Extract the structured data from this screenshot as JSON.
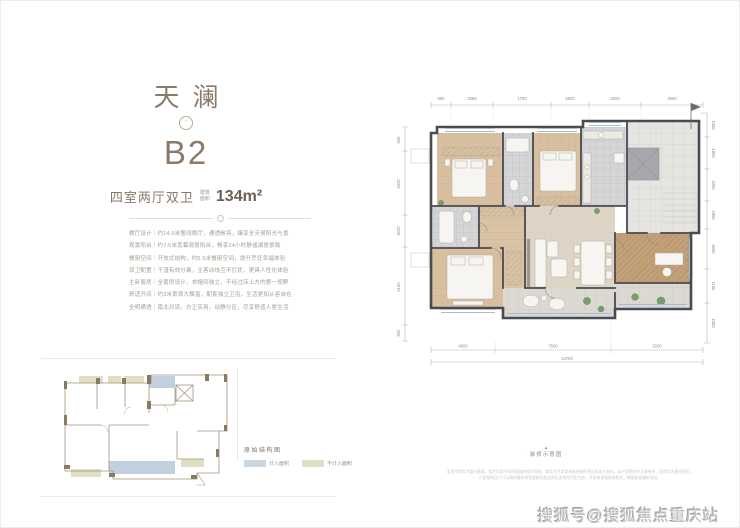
{
  "panel": {
    "project_name": "天澜",
    "unit_code": "B2",
    "layout_type": "四室两厅双卫",
    "area_label_line1": "建筑",
    "area_label_line2": "面积",
    "area_value": "134m²",
    "features": [
      "横厅设计｜约14.6米奢阔横厅，通透敞亮，臻享全天候阳光与景",
      "观景阳台｜约7.5米宽幕观景阳台，畅享24小时静谧湖居景致",
      "餐厨空间｜开放式结构，约5.5米餐厨空间，提升烹饪幸福体验",
      "双卫配置｜干湿有效分离，主客动线互不打扰，更具人性化体验",
      "主卧套房｜全套房设计，衣帽间独立，不经过床上方的第一视野",
      "舒适开间｜约3米景观大飘窗，配套独立卫浴，生活更加从容自在",
      "全明通透｜南北对流，方正实用，动静分区，尽享舒适人居生活"
    ]
  },
  "floorplan": {
    "caption_marker": "▲",
    "caption": "· 装修示意图 ·",
    "disclaimer_line1": "本宣传资料为要约邀请，相关内容不排除因政府相关规划、规定及开发商未能控制的原因而发生变化，本户型图仅作示意参考，面积均为建筑面积，",
    "disclaimer_line2": "户型结构及尺寸以政府最终审批图纸及商品房买卖合同约定为准，开发商保留修改权利，敬请留意最新资料。",
    "dims": {
      "top": [
        "900",
        "3285",
        "1700",
        "2800",
        "2000",
        "3600"
      ],
      "bottom": [
        "4000",
        "7500",
        "3200"
      ],
      "bottom_total": "14700",
      "left": [
        "600",
        "3320",
        "3020",
        "5100",
        "800"
      ],
      "right": [
        "1000",
        "1800",
        "3350",
        "1800",
        "3000",
        "1100",
        "1000"
      ]
    }
  },
  "legend": {
    "title": "原始结构图",
    "items": [
      {
        "label": "计入面积",
        "color": "#c9d6e4"
      },
      {
        "label": "不计入面积",
        "color": "#dfdfc3"
      }
    ]
  },
  "watermark": "搜狐号@搜狐焦点重庆站",
  "colors": {
    "accent_brown": "#8b7a67",
    "wall": "#4b4951",
    "wood_floor": "#d7bf9f",
    "tile_floor": "#d3d5d6",
    "marble_floor": "#ded5c6",
    "study_floor": "#c2a078",
    "balcony_floor": "#dcd9d3",
    "plant_green": "#76a06b"
  }
}
